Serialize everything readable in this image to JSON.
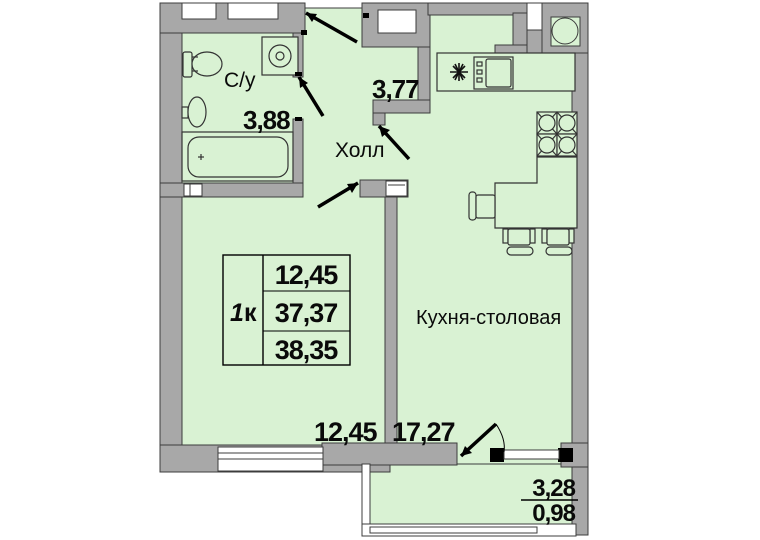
{
  "plan": {
    "unit": {
      "digit": "1",
      "letter": "к"
    },
    "summary": {
      "living_area": "12,45",
      "total_area": "37,37",
      "total_with_balcony": "38,35"
    },
    "rooms": {
      "bathroom": {
        "name": "С/у",
        "area": "3,88"
      },
      "hall": {
        "name": "Холл",
        "area": "3,77"
      },
      "kitchen": {
        "name": "Кухня-столовая",
        "area": "17,27"
      },
      "living_room": {
        "area": "12,45"
      },
      "balcony": {
        "area_full": "3,28",
        "area_counted": "0,98"
      }
    },
    "colors": {
      "floor": "#d9f2d3",
      "wall": "#a8a8a8",
      "outline": "#3c3c3c",
      "door": "#000000"
    },
    "fixtures": [
      "toilet",
      "sink",
      "bathtub",
      "washing-machine",
      "kitchen-counter",
      "oven",
      "burner",
      "hob",
      "kitchen-sink",
      "dining-table",
      "chairs"
    ]
  }
}
